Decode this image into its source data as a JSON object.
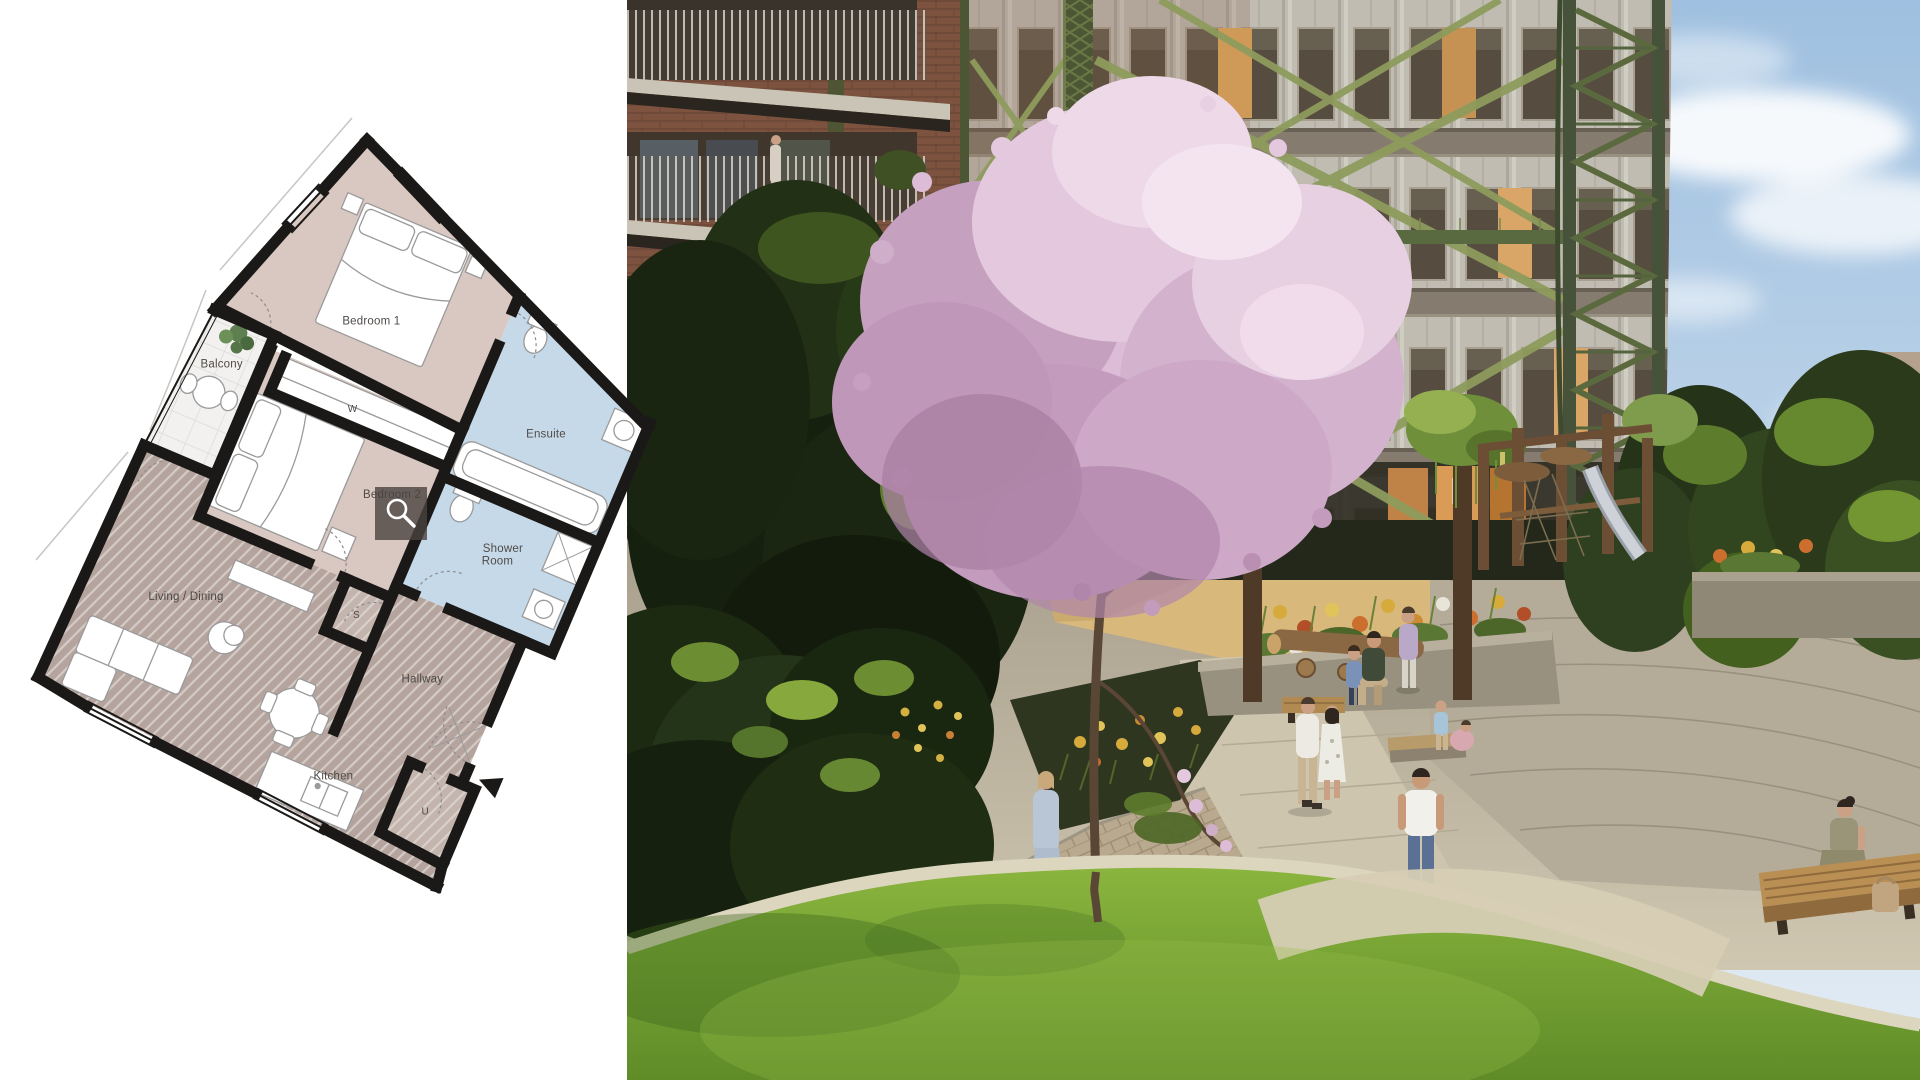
{
  "view": {
    "type": "property-media-split-view",
    "left_panel": "floor plan image on white background",
    "right_panel": "development render photo"
  },
  "floor_plan": {
    "rooms": [
      {
        "name": "bedroom-1",
        "label": "Bedroom 1"
      },
      {
        "name": "ensuite",
        "label": "Ensuite"
      },
      {
        "name": "balcony",
        "label": "Balcony"
      },
      {
        "name": "wardrobe",
        "label": "W"
      },
      {
        "name": "bedroom-2",
        "label": "Bedroom 2"
      },
      {
        "name": "shower-room",
        "label_lines": [
          "Shower",
          "Room"
        ]
      },
      {
        "name": "hallway",
        "label": "Hallway"
      },
      {
        "name": "living-dining",
        "label": "Living / Dining"
      },
      {
        "name": "store",
        "label": "S"
      },
      {
        "name": "utility",
        "label": "U"
      },
      {
        "name": "kitchen",
        "label": "Kitchen"
      }
    ],
    "colors": {
      "wall": "#1b1917",
      "bedroom_fill": "#d9c8c1",
      "wet_room_fill": "#c6d9e8",
      "hatched_fill": "#b5a49d",
      "closet_fill": "#c3b4ad",
      "balcony_fill": "#f2f1ef",
      "label": "#4f4a47"
    },
    "zoom_overlay": {
      "icon": "magnifier",
      "background": "rgba(74,66,62,0.8)",
      "glyph_color": "#ffffff"
    }
  },
  "photo": {
    "scene": "Courtyard garden render: circular apartment building inside a green gasholder guide frame, brick balcony building at left, pink magnolia blossom tree, play area with timber equipment, flower planters, stone paths, lawn and residents",
    "colors": {
      "sky_top": "#9fc0e0",
      "sky_bottom": "#d6e4f0",
      "frame_green": "#55643c",
      "brace_green": "#8e9c5c",
      "facade": "#ccc8be",
      "brick": "#7d5340",
      "blossom": "#dcbcd6",
      "lawn": "#7fae3a",
      "sand": "#d9b87c",
      "paving": "#c6bda6"
    }
  }
}
